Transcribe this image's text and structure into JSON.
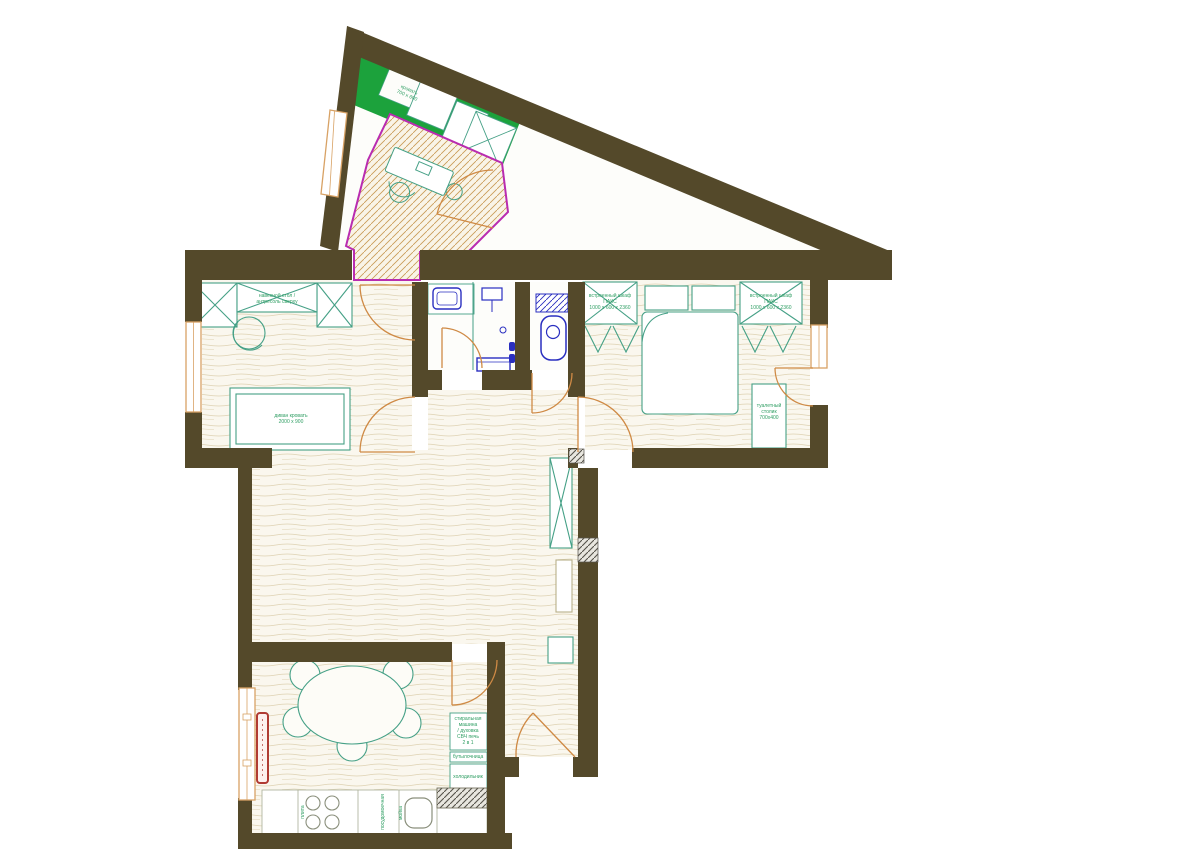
{
  "labels": {
    "study_cabinet": "кровать\n700 х 600",
    "living_shelf": "навесной стол /\nантресоль сверху",
    "sofa_bed": "диван кровать\n2000 х 900",
    "wardrobe_left": "встроенный шкаф\nПАКС\n1000 х 600 х 2360",
    "wardrobe_right": "встроенный шкаф\nПАКС\n1000 х 600 х 2360",
    "dressing_table": "туалетный\nстолик\n700х400",
    "appliances": "стиральная\nмашина\n/ духовка\nСВЧ печь\n2 в 1",
    "bottle_rack": "бутылочница",
    "fridge": "холодильник",
    "hob": "плита",
    "dishwasher": "посудомоечная",
    "sink": "мойка"
  },
  "colors": {
    "wall": "#54492a",
    "floor": "#faf7ee",
    "floorline": "#ded2b2",
    "furniture": "#45a086",
    "green": "#1ca23c",
    "magenta": "#b92cb0",
    "door": "#cf8a45",
    "window": "#d8a265",
    "fixture": "#2a2fc0",
    "radiator": "#b03a32",
    "label": "#2f9e63"
  }
}
